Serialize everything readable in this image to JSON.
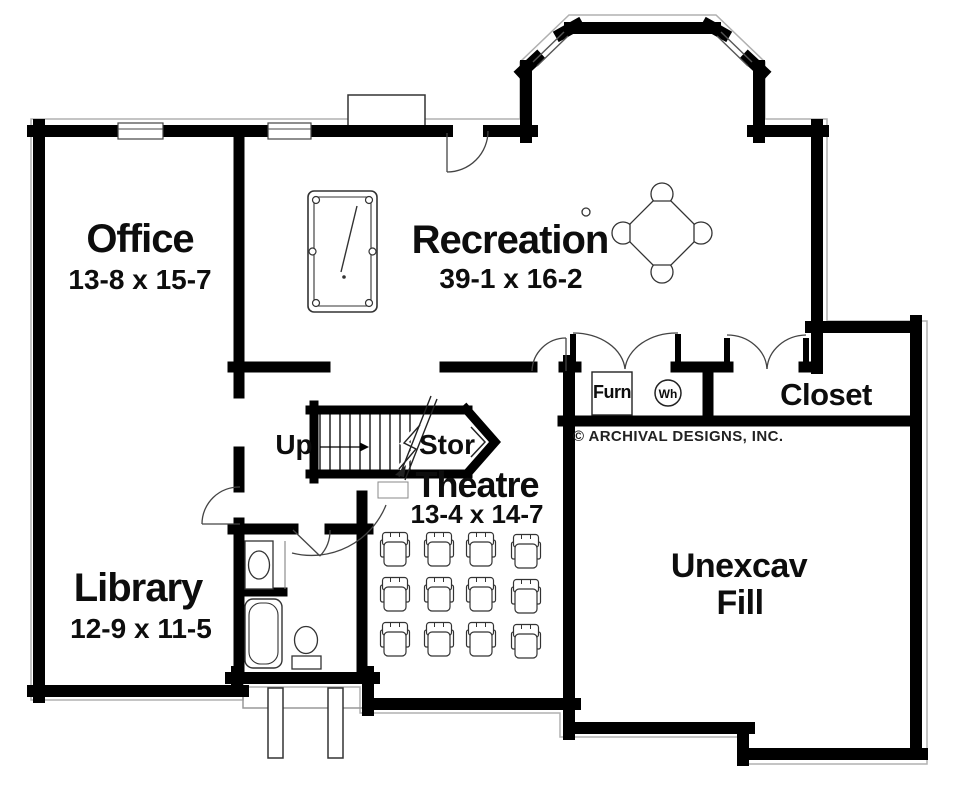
{
  "plan": {
    "copyright": "© ARCHIVAL DESIGNS, INC.",
    "rooms": {
      "office": {
        "name": "Office",
        "dims": "13-8 x 15-7"
      },
      "recreation": {
        "name": "Recreation",
        "dims": "39-1 x 16-2"
      },
      "library": {
        "name": "Library",
        "dims": "12-9 x 11-5"
      },
      "theatre": {
        "name": "Theatre",
        "dims": "13-4 x 14-7"
      },
      "closet": {
        "name": "Closet"
      },
      "unexcavated": {
        "name_line1": "Unexcav",
        "name_line2": "Fill"
      }
    },
    "annotations": {
      "stairs_up": "Up",
      "storage": "Stor",
      "furnace": "Furn",
      "water_heater": "Wh"
    },
    "colors": {
      "wall": "#000000",
      "fixture_line": "#333333",
      "footing": "#b0b0b0",
      "text": "#0d0d0d",
      "background": "#ffffff"
    }
  }
}
